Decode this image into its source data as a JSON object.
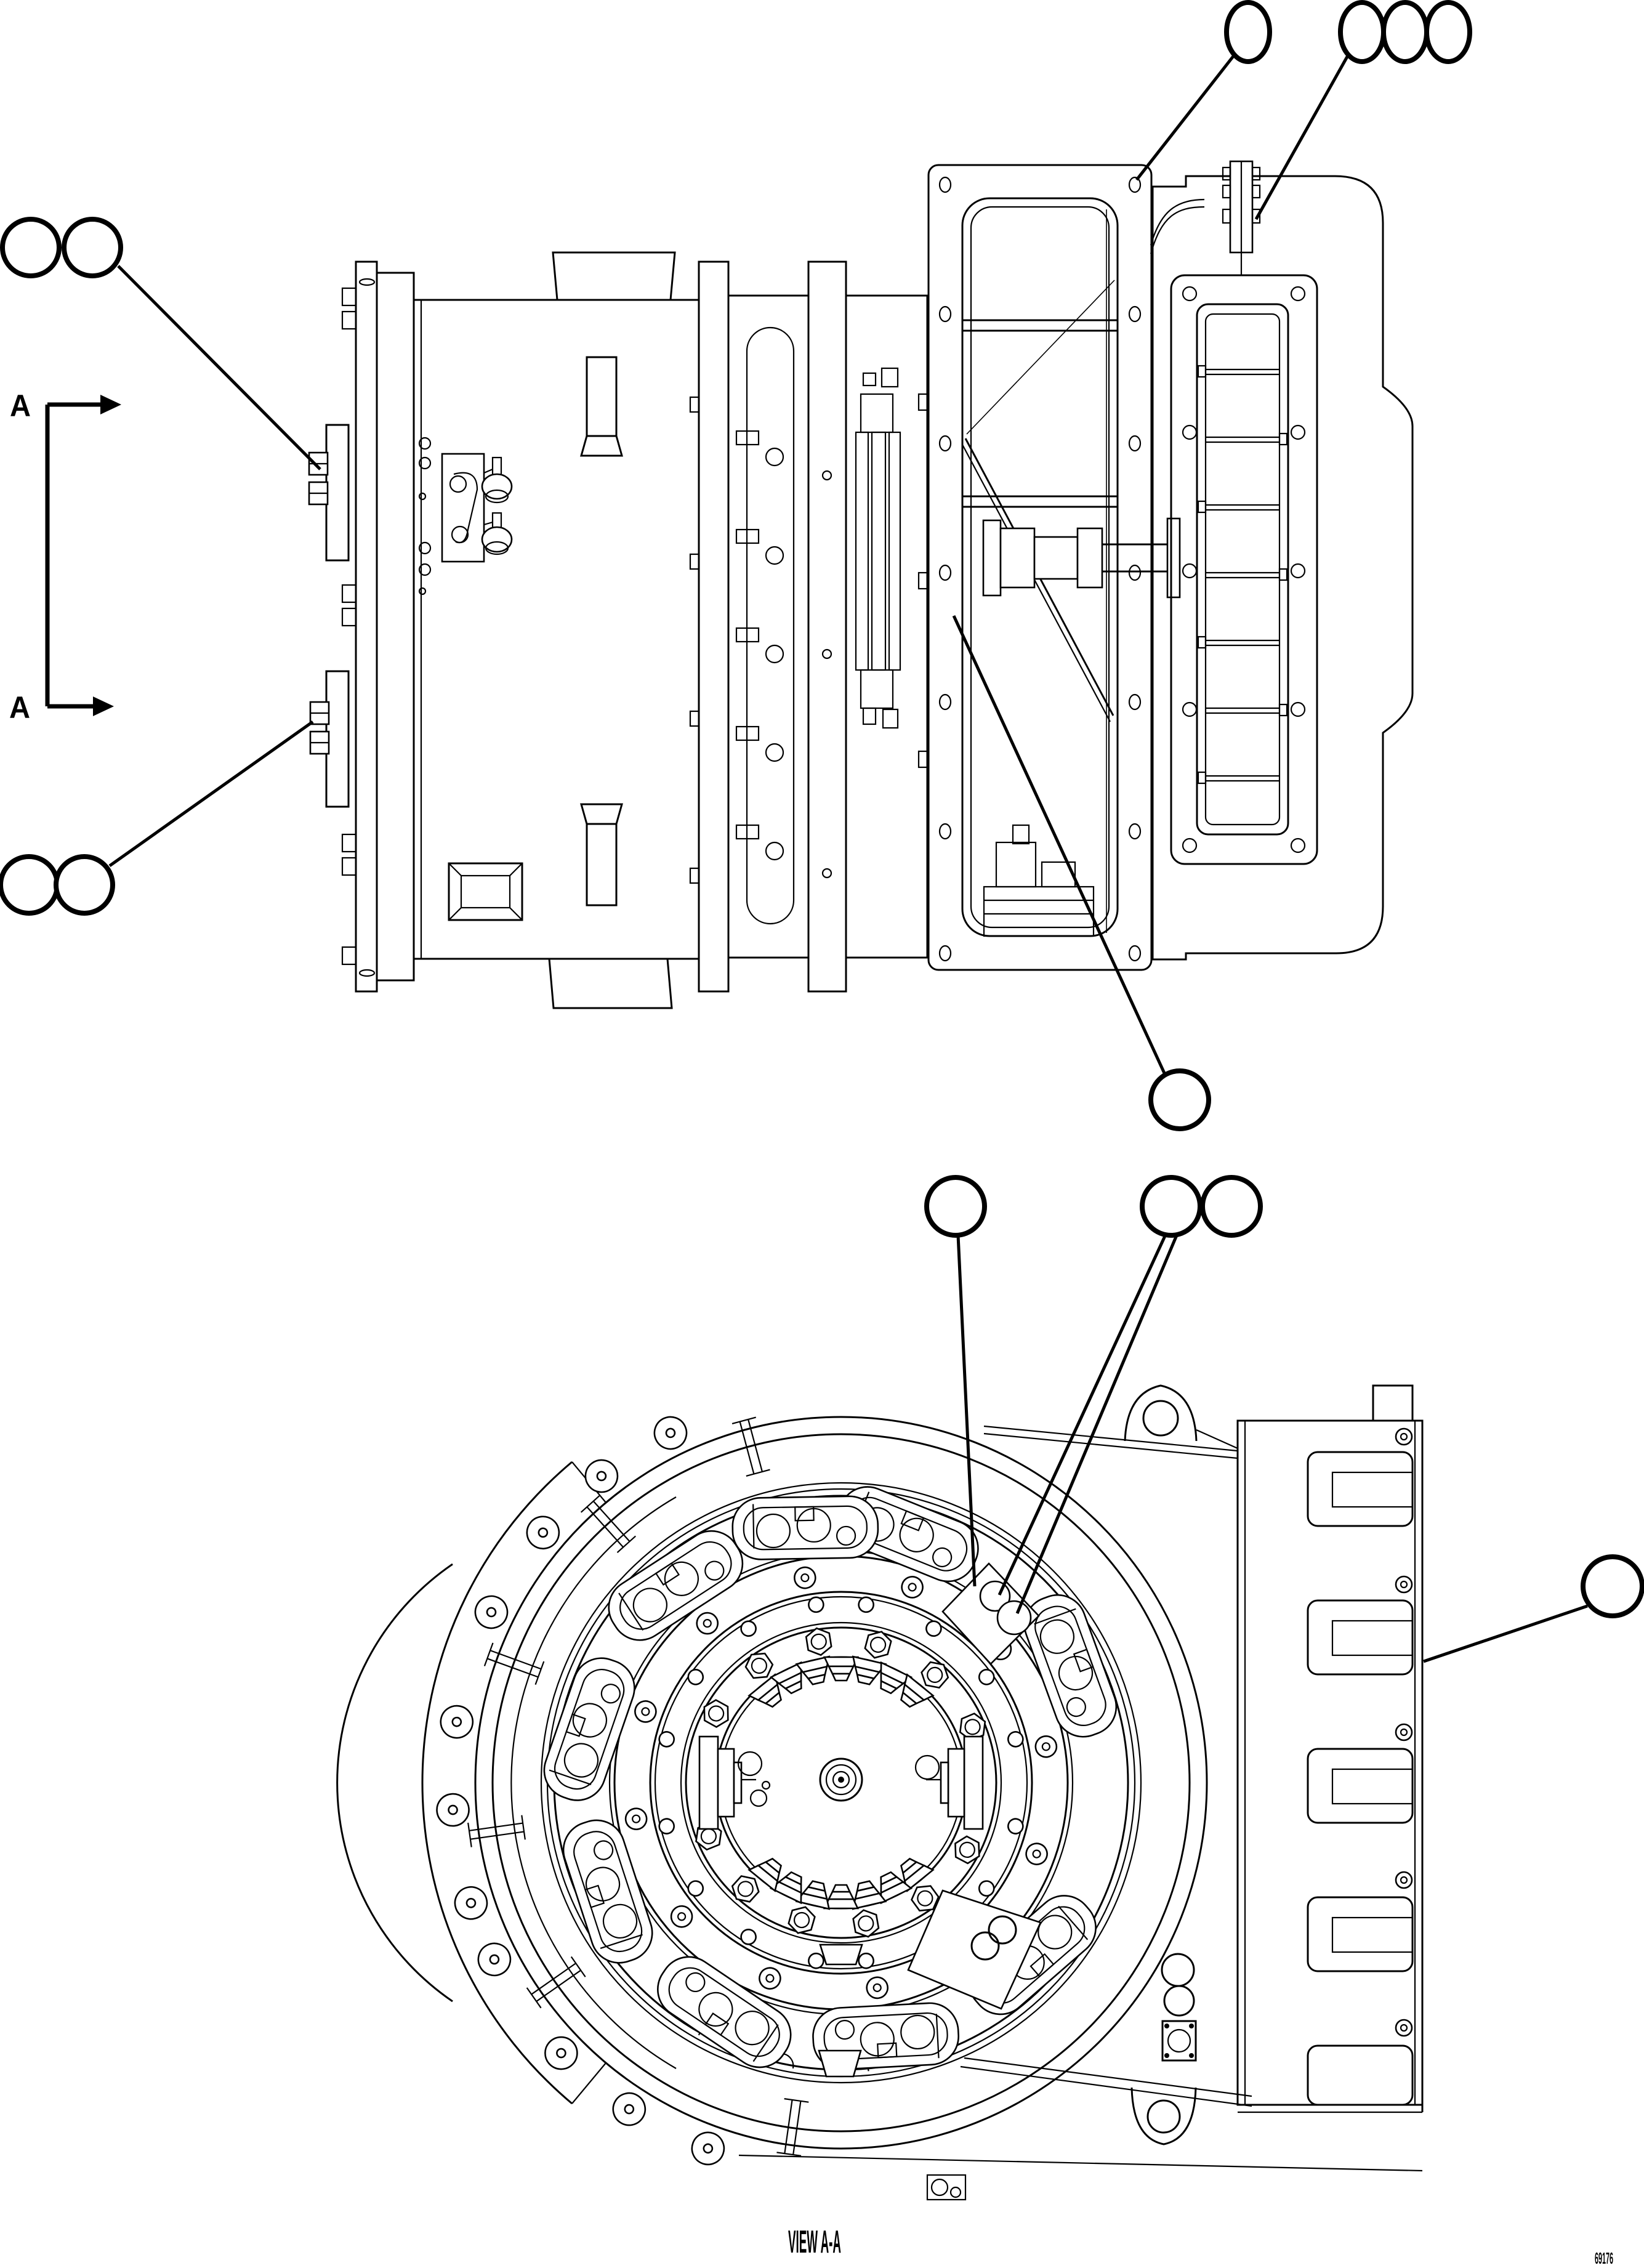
{
  "page": {
    "background": "#ffffff",
    "line_color": "#000000"
  },
  "title_block": {
    "view_label": "VIEW A-A",
    "drawing_number": "69176"
  },
  "section_marker": {
    "top_label": "A",
    "bottom_label": "A"
  },
  "callouts": {
    "side_view": [
      {
        "id": "balloon-1",
        "label": ""
      },
      {
        "id": "balloon-2",
        "label": ""
      },
      {
        "id": "balloon-3",
        "label": ""
      },
      {
        "id": "balloon-4",
        "label": ""
      },
      {
        "id": "balloon-5",
        "label": ""
      },
      {
        "id": "balloon-6",
        "label": ""
      },
      {
        "id": "balloon-7",
        "label": ""
      },
      {
        "id": "balloon-8",
        "label": ""
      },
      {
        "id": "balloon-9",
        "label": ""
      }
    ],
    "view_aa": [
      {
        "id": "balloon-10",
        "label": ""
      },
      {
        "id": "balloon-11",
        "label": ""
      },
      {
        "id": "balloon-12",
        "label": ""
      },
      {
        "id": "balloon-13",
        "label": ""
      }
    ]
  }
}
